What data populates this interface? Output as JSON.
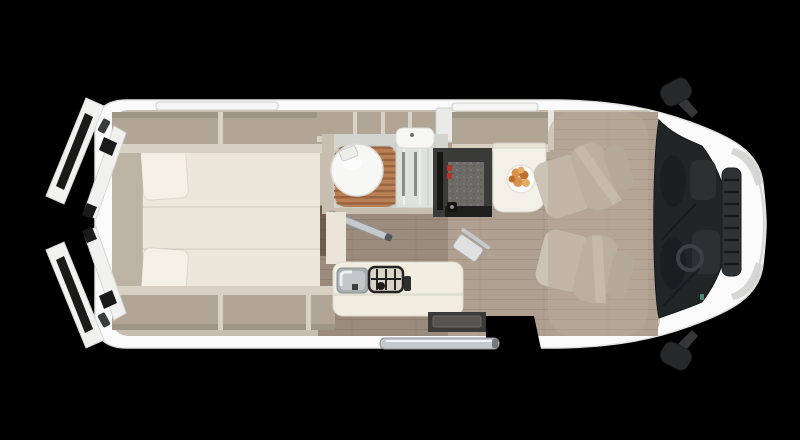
{
  "canvas": {
    "width": 800,
    "height": 440,
    "background": "#000000"
  },
  "scene": {
    "type": "campervan-floorplan-top-view",
    "visible_features": [
      "open-rear-barn-doors",
      "twin-beds-with-pillows",
      "overhead-storage-lockers",
      "bathroom-with-toilet-shower-grate-and-basin",
      "sliding-bathroom-door",
      "kitchen-counter-with-sink-and-hob",
      "fridge-tower-with-red-latches",
      "dinette-table-with-plate-of-food",
      "two-swivel-cab-seats",
      "cab-roof-cutaway-overlay",
      "windshield-with-dashboard",
      "side-mirrors",
      "front-grille-and-headlights",
      "entry-step-and-door-rail",
      "wood-plank-flooring"
    ]
  },
  "colors": {
    "background": "#000000",
    "body_white": "#fafafa",
    "body_edge": "#e2e2e0",
    "wall_beige": "#c7beb0",
    "headboard": "#bdb3a4",
    "locker_interior": "#b1a695",
    "locker_lip": "#d7d0c3",
    "divider_light": "#d9d3c7",
    "locker_wall": "#e8e6e1",
    "bed": "#ece7da",
    "pillow": "#f4f0e5",
    "floor_wood": "#9a8b7d",
    "floor_wood_light": "#b0a091",
    "floor_dark_wood": "#6f5d4f",
    "bath_floor": "#d3d3cf",
    "shower_wood": "#b97f55",
    "shower_wood_gap": "#99653f",
    "grate_frame": "#c9c9c5",
    "toilet_white": "#f7f7f5",
    "glass": "#dfe1df",
    "towel_bar": "#898c89",
    "fridge_dark": "#6b6a64",
    "fridge_frame": "#3a3a38",
    "accent_red": "#b23527",
    "panel_cream": "#e9e4d7",
    "counter": "#f1ede1",
    "sink_steel": "#a9aeb0",
    "sink_inner": "#c3c7c8",
    "hob_black": "#232322",
    "hob_base": "#d8d4c8",
    "table": "#f3f0e8",
    "table_edge": "#e7e3d8",
    "plate": "#fdfdfc",
    "food_orange": "#d9904a",
    "food_orange_dark": "#c0702e",
    "food_orange_light": "#e6aa60",
    "seat_fabric": "#bcb4a5",
    "seat_fabric_light": "#cbc4b6",
    "seat_headrest": "#b0a899",
    "seat_belt": "#d8d2c4",
    "cab_overlay": "rgba(186,170,152,0.52)",
    "windshield": "#212526",
    "windshield_inner": "#1a1e1f",
    "dash_dark": "#2e3334",
    "steering": "#3c4244",
    "green_detail": "#3f8f6f",
    "mirror_dark": "#27292a",
    "mirror_arm": "#343637",
    "chrome": "#c6c9cb",
    "rail_dark": "#8f9294",
    "step_dark": "#3a3a38",
    "step_mid": "#55544e",
    "door_white": "#f1f1ef",
    "door_slot": "#1a1a1a",
    "hinge_dark": "#3b3d3d",
    "window_slot": "#f5f5f3",
    "window_edge": "#cfcfcd",
    "headlight_gray": "#d6d7d5",
    "grille_dark": "#303334",
    "grille_slat": "#16181a"
  }
}
